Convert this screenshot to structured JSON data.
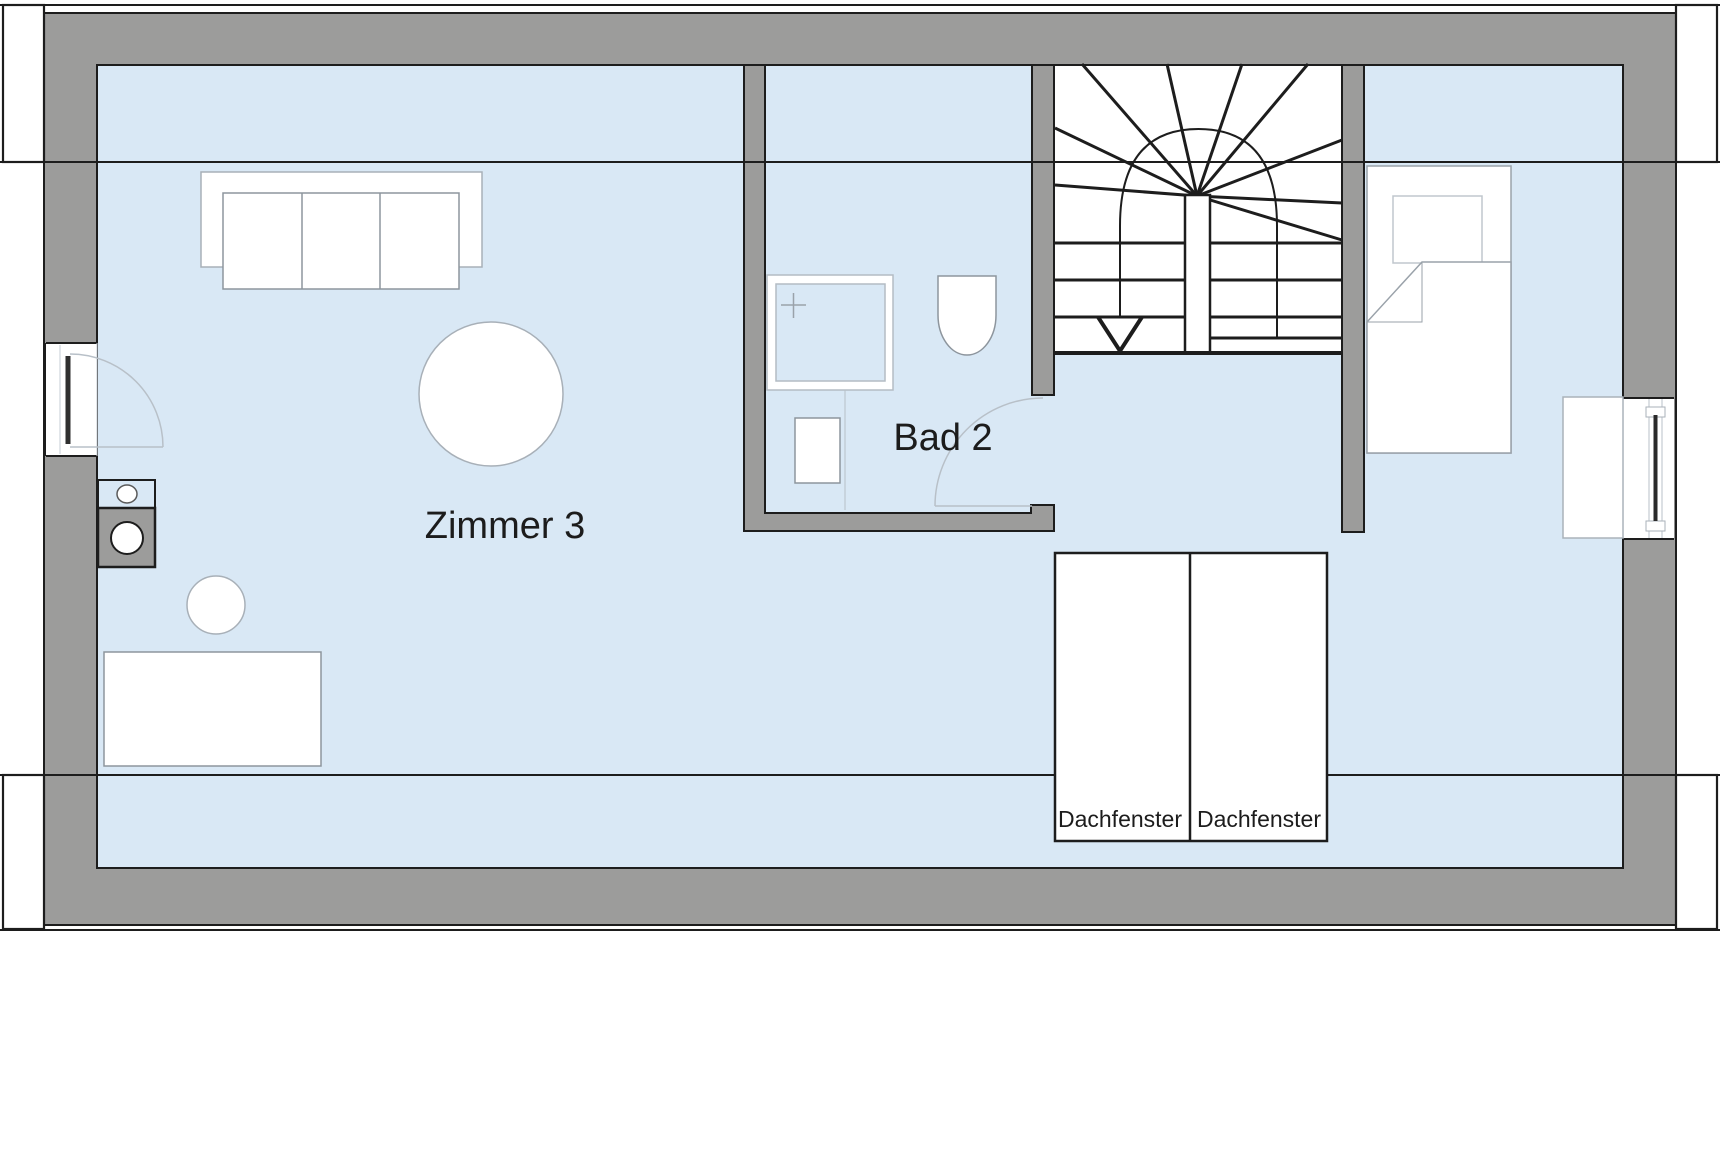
{
  "plan": {
    "title": "Dachgeschoss Grundriss",
    "rooms": [
      {
        "id": "zimmer-3",
        "label": "Zimmer 3"
      },
      {
        "id": "bad-2",
        "label": "Bad 2"
      }
    ],
    "roof_windows": [
      {
        "label": "Dachfenster"
      },
      {
        "label": "Dachfenster"
      }
    ],
    "icons": [
      "sofa-icon",
      "round-table-icon",
      "stool-icon",
      "desk-icon",
      "washing-machine-icon",
      "appliance-icon",
      "shower-icon",
      "toilet-icon",
      "washbasin-icon",
      "bed-icon",
      "staircase-icon",
      "door-swing-icon",
      "window-icon",
      "dormer-icon"
    ]
  },
  "colors": {
    "wall_fill": "#9c9c9b",
    "floor_fill": "#d9e8f5",
    "outline": "#1d1d1d",
    "furniture_stroke": "#8d959d",
    "light_stroke": "#b8c0c8",
    "door_leaf": "#2f2f2f",
    "text": "#1c1c1c",
    "background": "#ffffff"
  }
}
